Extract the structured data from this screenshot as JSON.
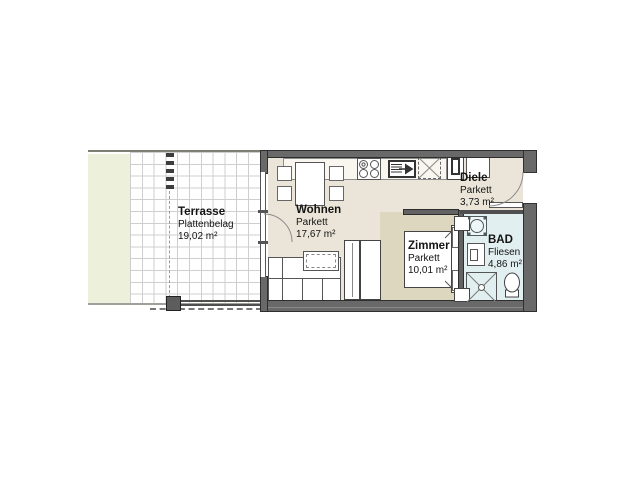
{
  "plan": {
    "type": "apartment-floor-plan",
    "rooms": {
      "terrasse": {
        "name": "Terrasse",
        "surface": "Plattenbelag",
        "area": "19,02 m²"
      },
      "wohnen": {
        "name": "Wohnen",
        "surface": "Parkett",
        "area": "17,67 m²"
      },
      "diele": {
        "name": "Diele",
        "surface": "Parkett",
        "area": "3,73 m²"
      },
      "zimmer": {
        "name": "Zimmer",
        "surface": "Parkett",
        "area": "10,01 m²"
      },
      "bad": {
        "name": "BAD",
        "surface": "Fliesen",
        "area": "4,86 m²"
      }
    },
    "fixtures": [
      "dining-table",
      "chair",
      "kitchen-counter",
      "stove",
      "kitchen-sink",
      "appliance-space",
      "tall-cabinet",
      "hall-wardrobe",
      "sofa",
      "coffee-table",
      "wardrobe",
      "bed",
      "washing-machine",
      "bath-sink",
      "shower",
      "toilet",
      "entrance-door-swing",
      "terrace-door-swing",
      "terrace-railing",
      "terrace-post"
    ],
    "colors": {
      "wall": "#696969",
      "floor_main": "#eae5d8",
      "floor_zimmer": "#ddd7c0",
      "floor_bad": "#e2eff1",
      "terrace_green": "#edf0db",
      "grid_line": "#cfcfcf",
      "text": "#141414"
    }
  }
}
